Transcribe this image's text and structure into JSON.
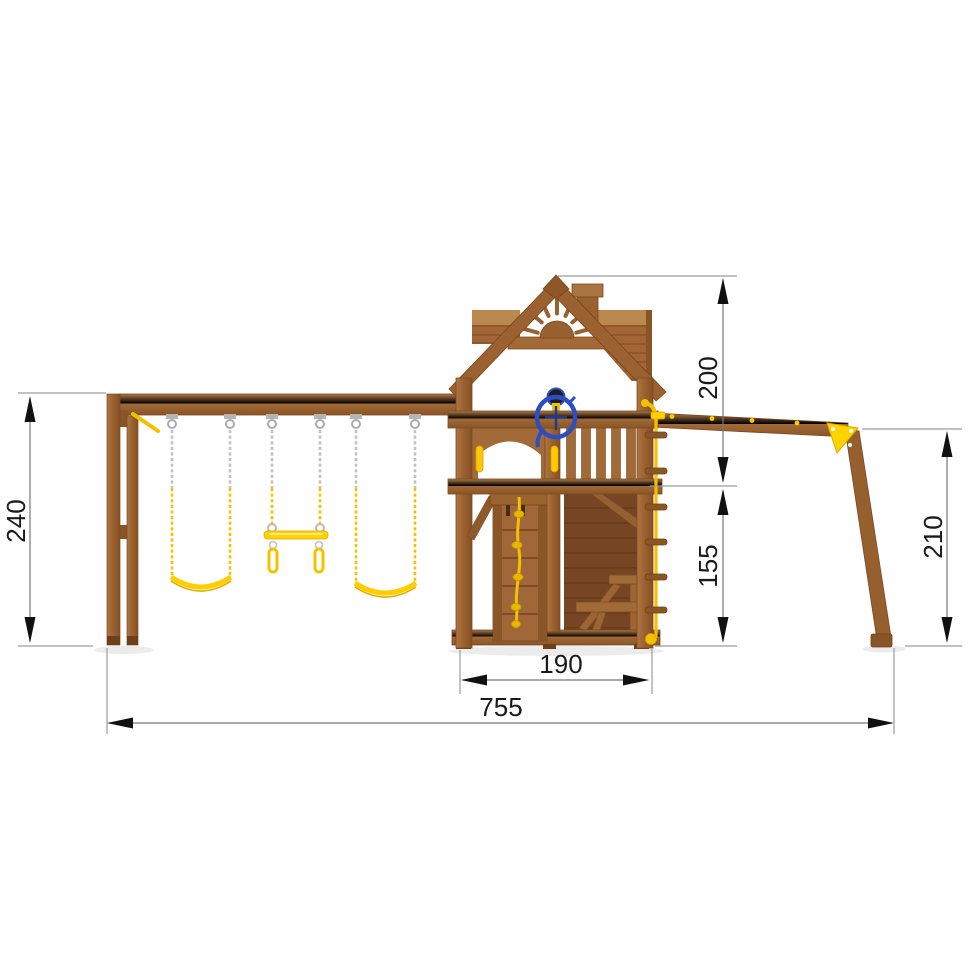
{
  "drawing": {
    "title": "wooden-playground-set-side-elevation",
    "dimensions": {
      "left_height": "240",
      "overall_width": "755",
      "tower_width": "190",
      "upper_section_height": "200",
      "lower_section_height": "155",
      "brace_height": "210"
    },
    "components": {
      "swing_count": "2",
      "trapeze": "trapeze bar with rings",
      "tower": "playhouse tower with gable roof, chimney and sunburst",
      "wheel": "steering wheel",
      "climber": "rope climbing board",
      "rope_ladder": "knotted climbing rope with cleats",
      "bench": "interior bench"
    },
    "colors": {
      "wood": "#A26A37",
      "wood_light": "#B5834E",
      "wood_dark": "#7B4A26",
      "wood_deep": "#6E4018",
      "accent_yellow": "#F5C500",
      "chain_grey": "#C2C2C2",
      "wheel_blue": "#2B4FC0",
      "dim_line": "#8A8A8A",
      "dim_text": "#1A1A1A",
      "background": "#FFFFFF"
    }
  }
}
